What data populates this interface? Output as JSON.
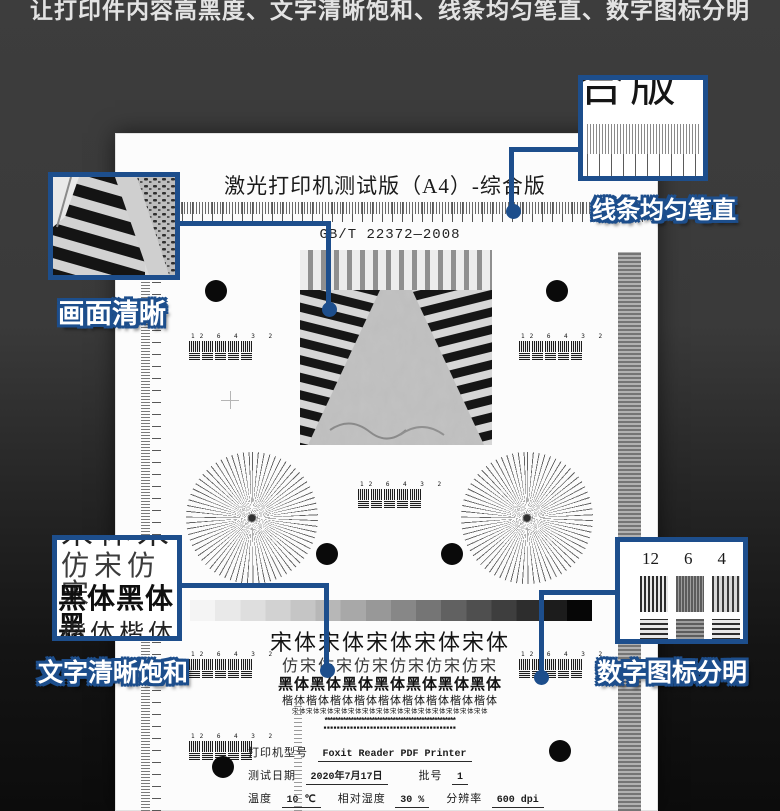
{
  "banner": {
    "text": "让打印件内容高黑度、文字清晰饱和、线条均匀笔直、数字图标分明"
  },
  "page": {
    "title": "激光打印机测试版（A4）-综合版",
    "standard": "GB/T 22372—2008",
    "res_numbers": "12 6 4 3 2",
    "font_samples": {
      "song": "宋体宋体宋体宋体宋体",
      "fangsong": "仿宋仿宋仿宋仿宋仿宋仿宋",
      "hei": "黑体黑体黑体黑体黑体黑体黑体",
      "kai": "楷体楷体楷体楷体楷体楷体楷体楷体楷体",
      "tiny": "宋体宋体宋体宋体宋体宋体宋体宋体宋体宋体宋体宋体宋体宋体",
      "stars": "**************************************************",
      "blocks": "■■■■■■■■■■■■■■■■■■■■■■■■■■■■■■■■■■■■■■■■"
    },
    "info": {
      "printer_label": "打印机型号",
      "printer_value": "Foxit Reader PDF Printer",
      "date_label": "测试日期",
      "date_value": "2020年7月17日",
      "batch_label": "批号",
      "batch_value": "1",
      "temp_label": "温度",
      "temp_value": "10 ℃",
      "humidity_label": "相对湿度",
      "humidity_value": "30 %",
      "dpi_label": "分辨率",
      "dpi_value": "600 dpi"
    }
  },
  "callouts": {
    "lines": {
      "label": "线条均匀笔直",
      "zoom_text": "合版"
    },
    "picture": {
      "label": "画面清晰"
    },
    "text": {
      "label": "文字清晰饱和",
      "zoom_top": "宋体宋",
      "zoom_line1": "仿宋仿宋",
      "zoom_line2": "黑体黑体黑",
      "zoom_line3": "楷体楷体楷"
    },
    "numbers": {
      "label": "数字图标分明",
      "zoom_numbers": [
        "12",
        "6",
        "4"
      ]
    }
  },
  "colors": {
    "accent_blue": "#1d4e8c",
    "backdrop_top": "#3c3c3c",
    "backdrop_bottom": "#0c0c0c",
    "page_background": "#fcfcfc"
  }
}
